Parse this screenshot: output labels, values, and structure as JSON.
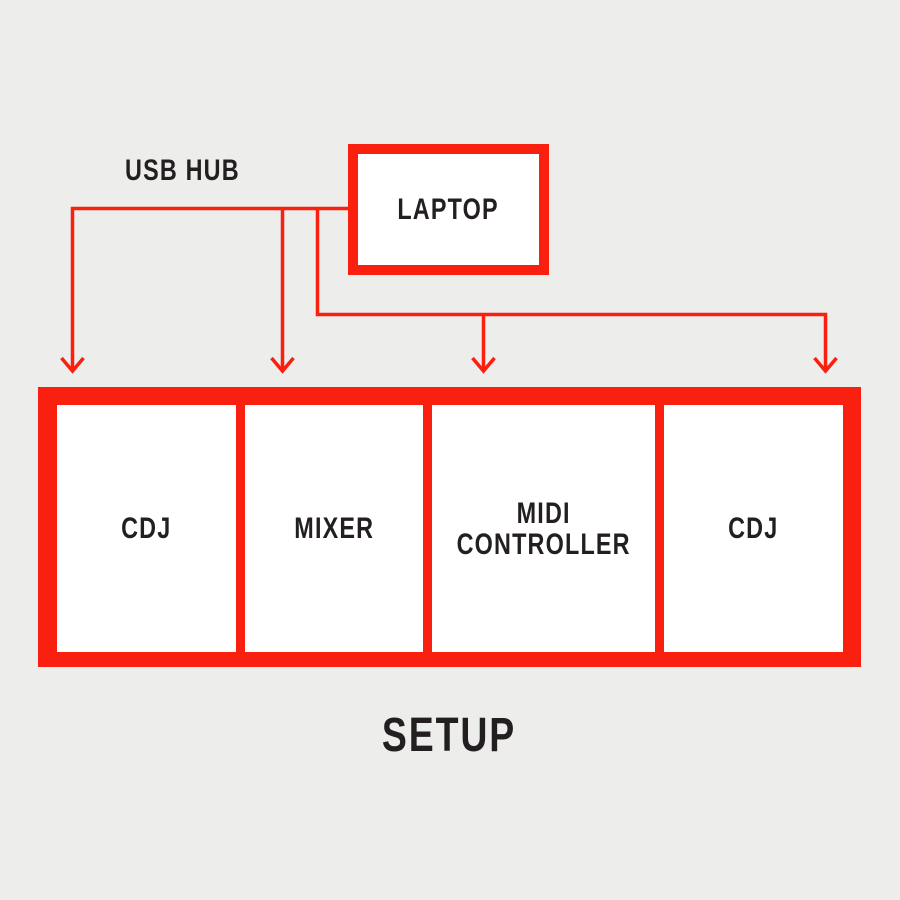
{
  "colors": {
    "accent_red": "#FA200F",
    "background": "#EDEDEB",
    "text_dark": "#231F20",
    "node_fill": "#FFFFFF"
  },
  "diagram": {
    "hub_label": "USB HUB",
    "laptop_label": "LAPTOP",
    "device_labels": [
      "CDJ",
      "MIXER",
      "MIDI CONTROLLER",
      "CDJ"
    ],
    "title": "SETUP"
  }
}
